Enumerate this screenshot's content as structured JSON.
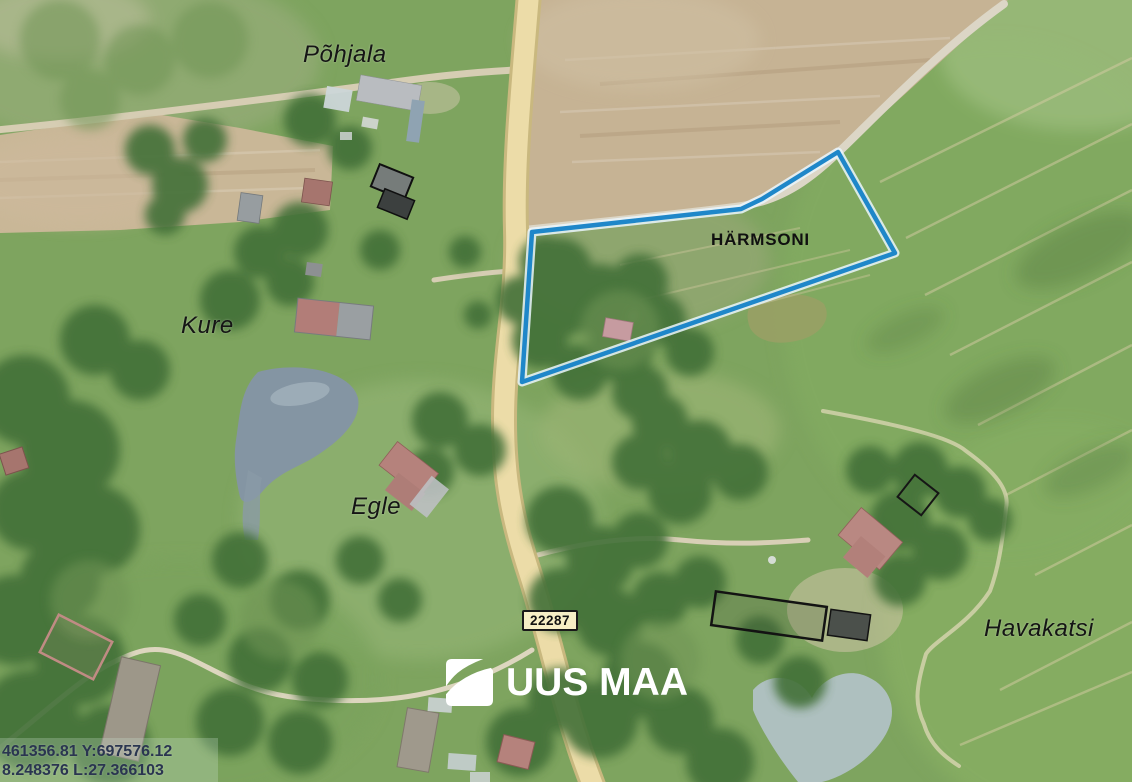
{
  "map": {
    "labels": {
      "pohjala": "Põhjala",
      "kure": "Kure",
      "egle": "Egle",
      "havakatsi": "Havakatsi",
      "harmsoni": "HÄRMSONI"
    },
    "road_badge": "22287",
    "boundary_color": "#1f87c9",
    "boundary_casing_color": "#eaf6fd"
  },
  "logo": {
    "text": "UUS MAA",
    "mark": "uus-maa-swoosh-square"
  },
  "status_bar": {
    "line1": "461356.81 Y:697576.12",
    "line2": "8.248376 L:27.366103"
  }
}
